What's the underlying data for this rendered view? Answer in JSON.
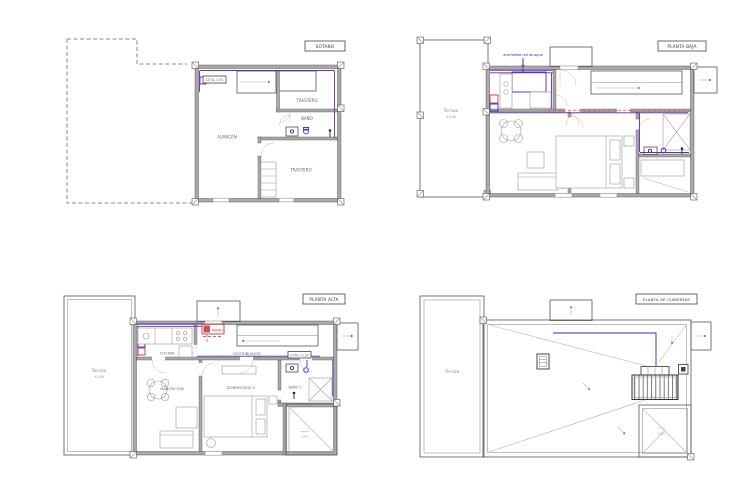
{
  "page": {
    "background": "#ffffff"
  },
  "palette": {
    "cold_water_pipe": "#2b2bd0",
    "hot_water_pipe": "#c03540",
    "distribution_pipe_violet": "#6a28b8",
    "return_dashed_pipe": "#e2654a",
    "walls": "#a9a9a9"
  },
  "plans": {
    "sotano": {
      "title": "SOTANO",
      "cota": "COTA -2.50",
      "rooms": {
        "trastero1": "TRASTERO",
        "bano": "BAÑO",
        "almacen": "ALMACÉN",
        "trastero2": "TRASTERO"
      }
    },
    "planta_baja": {
      "title": "PLANTA BAJA",
      "annotation": "acometida red de agua",
      "terraza": "Terraza",
      "terraza_cota": "±0.00"
    },
    "planta_alta": {
      "title": "PLANTA ALTA",
      "terraza": "Terraza",
      "terraza_cota": "+2.50",
      "cota": "COTA +2.50",
      "equipment": "TERMO",
      "slope": "1.5%",
      "rooms": {
        "cocina": "COCINA",
        "distribuidor": "DISTRIBUIDOR",
        "habitacion": "HABITACIÓN",
        "dormitorio2": "DORMITORIO 2",
        "bano2": "BAÑO 2"
      }
    },
    "cubiertas": {
      "title": "PLANTA DE CUBIERTAS",
      "terraza": "Terraza",
      "slope": "1.5%"
    }
  }
}
